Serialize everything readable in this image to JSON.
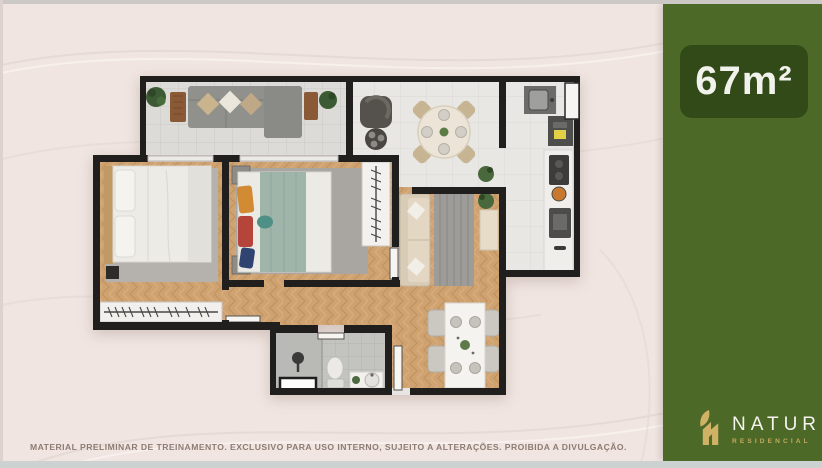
{
  "slide": {
    "area_badge": "67m²",
    "logo": {
      "brand": "NATUR",
      "tagline": "RESIDENCIAL"
    },
    "disclaimer": "MATERIAL PRELIMINAR DE TREINAMENTO. EXCLUSIVO PARA USO INTERNO, SUJEITO A ALTERAÇÕES. PROIBIDA A DIVULGAÇÃO.",
    "colors": {
      "background": "#f0e5e1",
      "sidebar_green": "#4d6928",
      "badge_green": "#314a18",
      "logo_gold": "#cfb266",
      "wall_dark": "#211f1d",
      "wood_floor": "#cfa271",
      "tile_floor": "#e8e7e3",
      "balcony_tile": "#dcdbd7",
      "bathroom_tile": "#c3c4c0",
      "bed_duvet_teal": "#9fb5aa",
      "sofa_gray": "#90908c",
      "sofa_beige": "#d9ccb7"
    }
  }
}
